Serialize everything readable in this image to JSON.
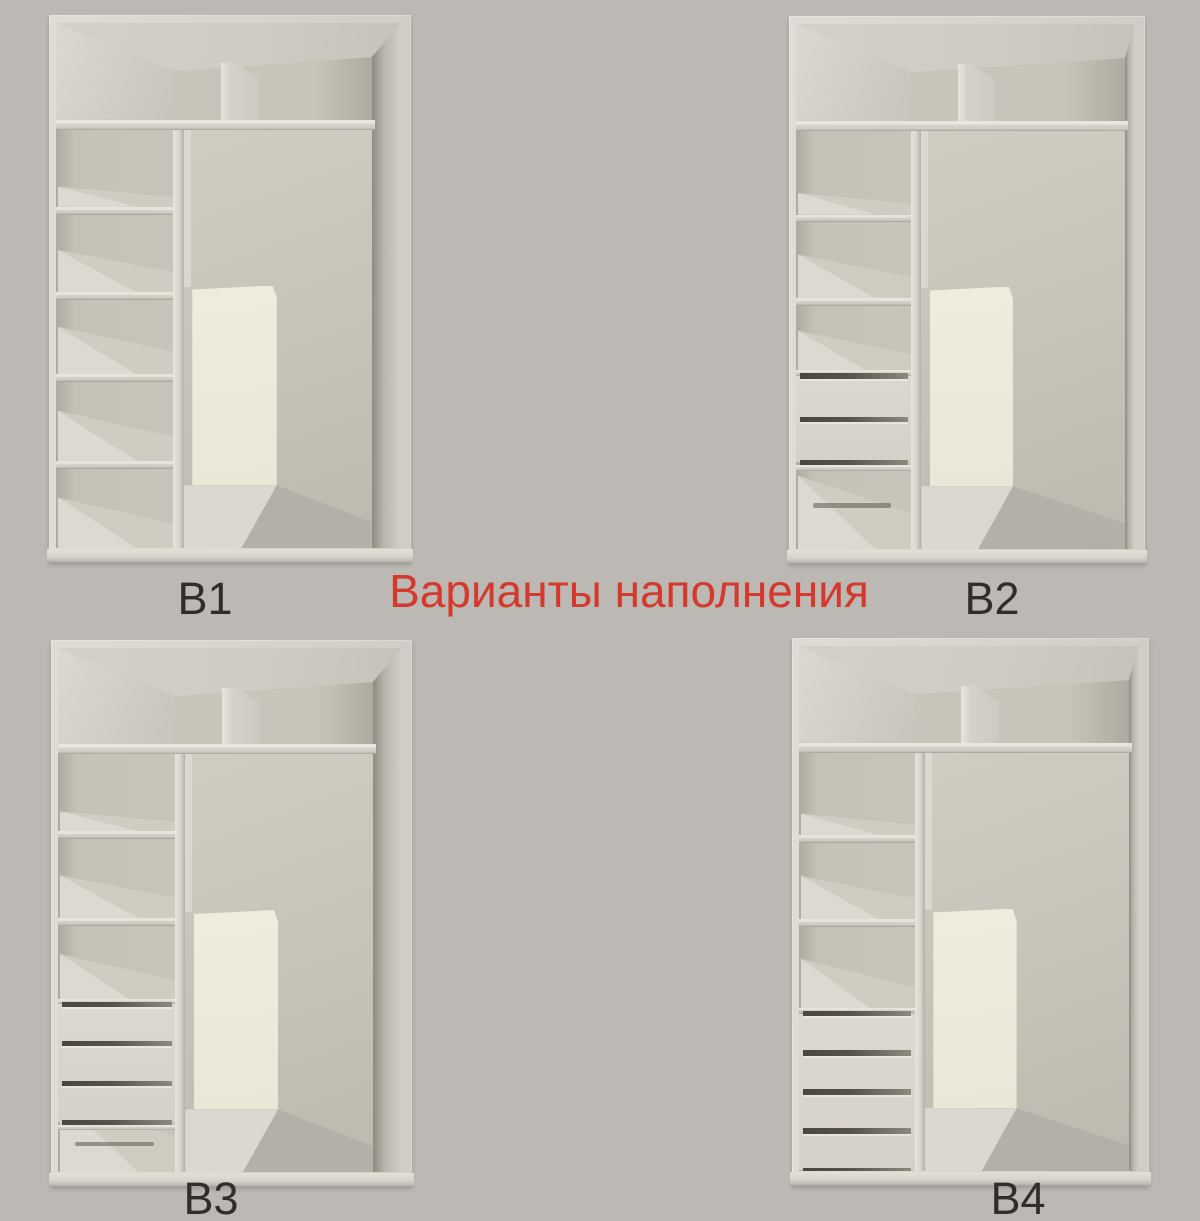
{
  "title": {
    "text": "Варианты наполнения"
  },
  "wardrobes": [
    {
      "label": "В1",
      "structure": {
        "top_shelf": true,
        "top_divider": true,
        "shelf_lines_pct": [
          35,
          51.3,
          66.9,
          83.4
        ],
        "drawers": {
          "count": 0,
          "top_pct": null,
          "bottom_pct": null
        },
        "shadow_line_pct": null,
        "back_panel": true
      }
    },
    {
      "label": "В2",
      "structure": {
        "top_shelf": true,
        "top_divider": true,
        "shelf_lines_pct": [
          36.3,
          52.2
        ],
        "drawers": {
          "count": 2,
          "top_pct": 67,
          "bottom_pct": 83.5
        },
        "shadow_line_pct": 91.3,
        "back_panel": true
      }
    },
    {
      "label": "В3",
      "structure": {
        "top_shelf": true,
        "top_divider": true,
        "shelf_lines_pct": [
          35,
          51.5
        ],
        "drawers": {
          "count": 3,
          "top_pct": 68,
          "bottom_pct": 90.5
        },
        "shadow_line_pct": 94.3,
        "back_panel": true
      }
    },
    {
      "label": "В4",
      "structure": {
        "top_shelf": true,
        "top_divider": true,
        "shelf_lines_pct": [
          36,
          52
        ],
        "drawers": {
          "count": 4,
          "top_pct": 70,
          "bottom_pct": 99.8
        },
        "shadow_line_pct": null,
        "back_panel": true
      }
    }
  ],
  "colors": {
    "background": "#bcb8b3",
    "label_text": "#2f2e2b",
    "title_red": "#d4392e",
    "wood": "#d8d4cd",
    "wood_light": "#e7e3dd",
    "wood_mid": "#cfcbc4",
    "wood_dark": "#a39f97",
    "back_wall": "#c8c4b9",
    "back_wall_dark": "#aeaaa0",
    "surface_bright": "#ddd9d1",
    "surface_mid": "#d0ccc2",
    "panel_cream": "#efecdd",
    "floor_wood": "#dbd8cf",
    "drawer_gap": "#49453f",
    "shadow": "#5f5c55"
  }
}
